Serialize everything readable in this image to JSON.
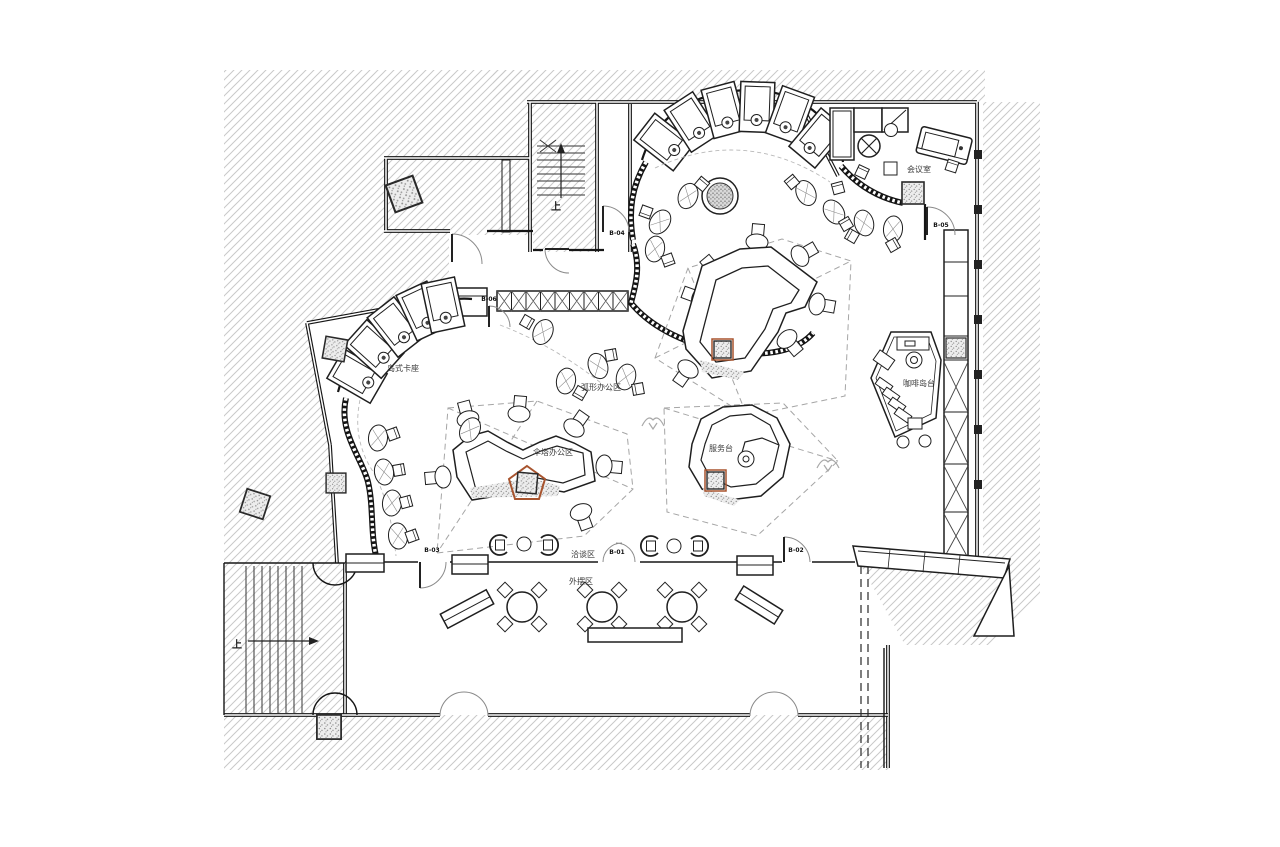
{
  "labels": {
    "meeting_room": "会议室",
    "coffee_island": "咖啡岛台",
    "service_desk": "服务台",
    "arc_office": "弧形办公区",
    "canopy_office": "伞塔办公区",
    "island_booth": "岛式卡座",
    "negotiation": "洽谈区",
    "outdoor": "外摆区",
    "stair_up_top": "上",
    "stair_up_bottom": "上"
  },
  "doors": {
    "b01": "B-01",
    "b02": "B-02",
    "b03": "B-03",
    "b04": "B-04",
    "b05": "B-05",
    "b06": "B-06"
  },
  "colors": {
    "line": "#161616",
    "hatch": "#c9c9c9",
    "dashed_guide": "#a5a5a5",
    "column_accent": "#a8542e"
  }
}
